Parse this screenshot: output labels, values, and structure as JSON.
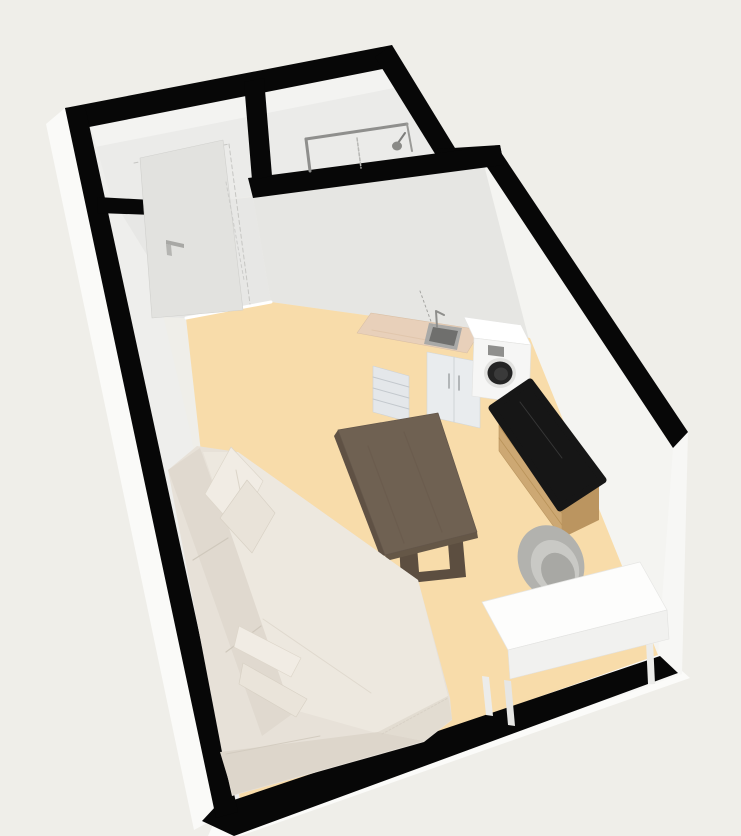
{
  "view": {
    "type": "3d-floorplan-render",
    "width": 741,
    "height": 836,
    "background": "#efeee9"
  },
  "palette": {
    "wall_top": "#070707",
    "wall_outer_face": "#fafaf8",
    "wall_inner_face": "#f3f3f1",
    "hall_floor": "#e7e7e5",
    "living_floor": "#f8dcaa",
    "sofa_cream": "#e7e1d8",
    "table_wood": "#6f6152",
    "sideboard_wood": "#cda873",
    "sideboard_marble": "#161616",
    "kitchen_counter": "#e8d0ba",
    "appliance_white": "#f6f6f5",
    "chair_gray": "#b2b2ae",
    "desk_white": "#fdfdfc"
  },
  "rooms": [
    {
      "name": "entry-hall",
      "floor_color": "#e7e7e5"
    },
    {
      "name": "bathroom",
      "floor_color": "#ebebe9"
    },
    {
      "name": "living-room-kitchen",
      "floor_color": "#f8dcaa"
    }
  ],
  "furniture": [
    {
      "name": "entry-door",
      "color": "#e2e2df"
    },
    {
      "name": "shower",
      "color": "#8f8f8d"
    },
    {
      "name": "kitchen-counter-sink",
      "color": "#e8d0ba"
    },
    {
      "name": "washing-machine",
      "color": "#f6f6f5"
    },
    {
      "name": "sideboard",
      "color": "#cda873"
    },
    {
      "name": "chair",
      "color": "#b2b2ae"
    },
    {
      "name": "desk",
      "color": "#fdfdfc"
    },
    {
      "name": "dining-table",
      "color": "#6f6152"
    },
    {
      "name": "sectional-sofa",
      "color": "#e7e1d8"
    }
  ],
  "shapes": [
    {
      "name": "background",
      "kind": "polygon",
      "points": "0,0 741,0 741,836 0,836",
      "fill": "#efeee9",
      "interactable": false
    },
    {
      "name": "wall-outer-face-left",
      "kind": "polygon",
      "points": "65,108 218,817 194,830 46,124",
      "fill": "#fafaf8",
      "interactable": false
    },
    {
      "name": "wall-outer-face-bottom",
      "kind": "polygon",
      "points": "216,818 672,662 690,678 240,836 208,836",
      "fill": "#fbfbf9",
      "interactable": false
    },
    {
      "name": "wall-outer-face-right",
      "kind": "polygon",
      "points": "688,432 682,674 610,700 600,600 650,470",
      "fill": "#f7f7f5",
      "interactable": false
    },
    {
      "name": "hall-bathroom-interior",
      "kind": "polygon",
      "points": "74,130 398,66 440,158 503,148 253,196 153,212 97,210",
      "fill": "#ebebe9",
      "interactable": false
    },
    {
      "name": "wall-face-top-inner",
      "kind": "polygon",
      "points": "74,130 398,66 404,86 80,150",
      "fill": "#f3f3f1",
      "interactable": false
    },
    {
      "name": "hall-corridor-floor",
      "kind": "polygon",
      "points": "118,212 253,197 271,302 186,318 136,316",
      "fill": "#e7e7e5",
      "interactable": false
    },
    {
      "name": "wall-face-partition",
      "kind": "polygon",
      "points": "253,197 504,164 530,338 271,302",
      "fill": "#e6e6e3",
      "interactable": false
    },
    {
      "name": "wall-face-right-inner",
      "kind": "polygon",
      "points": "483,161 673,448 658,656 528,336",
      "fill": "#f4f4f1",
      "interactable": false
    },
    {
      "name": "wall-face-left-inner",
      "kind": "polygon",
      "points": "85,106 238,812 254,786 190,430 150,260 110,195",
      "fill": "#eeeeec",
      "interactable": false
    },
    {
      "name": "wall-face-bottom-inner",
      "kind": "polygon",
      "points": "218,808 658,654 662,660 222,814",
      "fill": "#fafaf8",
      "interactable": false
    },
    {
      "name": "floor-living-room",
      "kind": "polygon",
      "points": "186,318 271,302 530,338 658,655 240,802",
      "fill": "#f8dcaa",
      "interactable": false
    },
    {
      "name": "floor-threshold-line",
      "kind": "line",
      "points": "186,318 271,302",
      "stroke": "#ffffff",
      "sw": 3,
      "interactable": false
    },
    {
      "name": "wall-top-northwest",
      "kind": "polygon",
      "points": "65,108 392,45 398,66 74,130",
      "fill": "#070707",
      "interactable": false
    },
    {
      "name": "wall-top-bathroom-right",
      "kind": "polygon",
      "points": "392,45 455,148 437,157 375,57",
      "fill": "#070707",
      "interactable": false
    },
    {
      "name": "wall-top-jog",
      "kind": "polygon",
      "points": "437,149 500,145 504,165 441,160",
      "fill": "#070707",
      "interactable": false
    },
    {
      "name": "wall-top-right",
      "kind": "polygon",
      "points": "496,145 688,432 673,448 483,161",
      "fill": "#070707",
      "interactable": false
    },
    {
      "name": "wall-top-bottom",
      "kind": "polygon",
      "points": "216,806 660,656 678,673 234,836 202,821",
      "fill": "#070707",
      "interactable": false
    },
    {
      "name": "wall-top-left",
      "kind": "polygon",
      "points": "65,108 85,106 238,812 216,818",
      "fill": "#070707",
      "interactable": false
    },
    {
      "name": "wall-top-partition-stub",
      "kind": "polygon",
      "points": "97,197 152,200 153,215 98,213",
      "fill": "#070707",
      "interactable": false
    },
    {
      "name": "wall-top-partition-main",
      "kind": "polygon",
      "points": "248,178 500,145 504,165 253,198",
      "fill": "#070707",
      "interactable": false
    },
    {
      "name": "wall-top-hall-bath-divider",
      "kind": "polygon",
      "points": "244,82 264,78 272,176 252,180",
      "fill": "#070707",
      "interactable": false
    },
    {
      "name": "door-casing-dash-top",
      "kind": "line",
      "points": "134,163 229,144",
      "stroke": "#c6c6c3",
      "sw": 1,
      "dash": "4,3",
      "interactable": false
    },
    {
      "name": "door-casing-dash-right",
      "kind": "line",
      "points": "229,144 250,304",
      "stroke": "#c6c6c3",
      "sw": 1,
      "dash": "4,3",
      "interactable": false
    },
    {
      "name": "entry-door-leaf",
      "kind": "polygon",
      "points": "140,158 223,140 243,310 152,318",
      "fill": "#e2e2df",
      "stroke": "#d0d0cd",
      "sw": 0.6,
      "interactable": true
    },
    {
      "name": "door-handle-icon",
      "kind": "polygon",
      "points": "166,240 184,244 184,248 166,244",
      "fill": "#a8a8a5",
      "interactable": true
    },
    {
      "name": "door-handle-stem",
      "kind": "polygon",
      "points": "166,244 171,245 172,256 167,255",
      "fill": "#b5b5b2",
      "interactable": false
    },
    {
      "name": "corridor-guide-dash",
      "kind": "line",
      "points": "226,182 244,280",
      "stroke": "#cccccA",
      "sw": 1,
      "dash": "3,3",
      "interactable": false
    },
    {
      "name": "shower-frame-top-bar",
      "kind": "line",
      "points": "306,139 407,124",
      "stroke": "#8f8f8d",
      "sw": 3,
      "interactable": true
    },
    {
      "name": "shower-frame-left-bar",
      "kind": "line",
      "points": "306,139 310,171",
      "stroke": "#8f8f8d",
      "sw": 3,
      "interactable": false
    },
    {
      "name": "shower-frame-right-bar",
      "kind": "line",
      "points": "407,124 412,151",
      "stroke": "#9a9a97",
      "sw": 2,
      "interactable": false
    },
    {
      "name": "shower-glass-dash",
      "kind": "line",
      "points": "357,138 361,168",
      "stroke": "#b8b8b5",
      "sw": 1.5,
      "dash": "3,2",
      "interactable": false
    },
    {
      "name": "shower-head-arm",
      "kind": "line",
      "points": "405,133 398,143",
      "stroke": "#7e7e7c",
      "sw": 2,
      "interactable": false
    },
    {
      "name": "shower-head-icon",
      "kind": "ellipse",
      "cx": 397,
      "cy": 146,
      "rx": 5,
      "ry": 4.5,
      "fill": "#8a8a87",
      "interactable": true
    },
    {
      "name": "kitchen-drawer-unit",
      "kind": "polygon",
      "points": "373,366 409,376 409,422 373,412",
      "fill": "#e4e7ea",
      "stroke": "#cdd2d7",
      "sw": 0.6,
      "interactable": true
    },
    {
      "name": "kitchen-drawer-line-1",
      "kind": "line",
      "points": "373,377 409,387",
      "stroke": "#c3c8cd",
      "sw": 1,
      "interactable": false
    },
    {
      "name": "kitchen-drawer-line-2",
      "kind": "line",
      "points": "373,388 409,398",
      "stroke": "#c3c8cd",
      "sw": 1,
      "interactable": false
    },
    {
      "name": "kitchen-drawer-line-3",
      "kind": "line",
      "points": "373,399 409,409",
      "stroke": "#c3c8cd",
      "sw": 1,
      "interactable": false
    },
    {
      "name": "kitchen-sink-cabinet",
      "kind": "polygon",
      "points": "427,352 480,362 480,428 427,416",
      "fill": "#e9ecee",
      "stroke": "#d2d7da",
      "sw": 0.6,
      "interactable": true
    },
    {
      "name": "cabinet-door-split-line",
      "kind": "line",
      "points": "454,357 454,422",
      "stroke": "#cfd4d7",
      "sw": 1,
      "interactable": false
    },
    {
      "name": "cabinet-handle-left",
      "kind": "line",
      "points": "449,374 449,388",
      "stroke": "#9fa3a6",
      "sw": 1.5,
      "interactable": false
    },
    {
      "name": "cabinet-handle-right",
      "kind": "line",
      "points": "459,376 459,390",
      "stroke": "#9fa3a6",
      "sw": 1.5,
      "interactable": false
    },
    {
      "name": "kitchen-countertop",
      "kind": "polygon",
      "points": "357,333 371,313 481,330 467,353",
      "fill": "#e8d0ba",
      "stroke": "#d9bfa5",
      "sw": 0.6,
      "interactable": true
    },
    {
      "name": "countertop-streak",
      "kind": "line",
      "points": "372,330 432,341",
      "stroke": "#dfc3a9",
      "sw": 1,
      "opacity": 0.8,
      "interactable": false
    },
    {
      "name": "kitchen-sink-rim",
      "kind": "polygon",
      "points": "429,323 462,328 457,350 424,344",
      "fill": "#a9a9a7",
      "interactable": true
    },
    {
      "name": "kitchen-sink-basin",
      "kind": "polygon",
      "points": "433,327 458,331 454,346 429,341",
      "fill": "#6f6f6d",
      "interactable": false
    },
    {
      "name": "kitchen-faucet-icon",
      "kind": "path",
      "d": "M437,327 L436,311 L444,315",
      "fill": "none",
      "stroke": "#8e8e8b",
      "sw": 2,
      "interactable": false
    },
    {
      "name": "plumbing-guide-dash",
      "kind": "line",
      "points": "420,291 433,327",
      "stroke": "#a5a5a2",
      "sw": 1,
      "dash": "2,3",
      "interactable": false
    },
    {
      "name": "washing-machine-top",
      "kind": "polygon",
      "points": "464,317 521,325 531,345 474,338",
      "fill": "#ffffff",
      "stroke": "#e5e5e3",
      "sw": 0.6,
      "interactable": true
    },
    {
      "name": "washing-machine-front",
      "kind": "polygon",
      "points": "474,338 531,345 529,404 472,396",
      "fill": "#f6f6f5",
      "stroke": "#e2e2e0",
      "sw": 0.6,
      "interactable": true
    },
    {
      "name": "washer-control-panel",
      "kind": "polygon",
      "points": "488,345 504,347 504,357 488,355",
      "fill": "#8f8f8d",
      "interactable": false
    },
    {
      "name": "washer-door-ring",
      "kind": "ellipse",
      "cx": 500,
      "cy": 373,
      "rx": 16,
      "ry": 15,
      "fill": "#e2e2e0",
      "interactable": false
    },
    {
      "name": "washer-door",
      "kind": "ellipse",
      "cx": 500,
      "cy": 373,
      "rx": 12.5,
      "ry": 11.5,
      "fill": "#242424",
      "interactable": true
    },
    {
      "name": "washer-door-glass",
      "kind": "ellipse",
      "cx": 501,
      "cy": 374,
      "rx": 7,
      "ry": 6.5,
      "fill": "#3a3a3a",
      "interactable": false
    },
    {
      "name": "sideboard-front-face",
      "kind": "polygon",
      "points": "499,413 562,500 562,538 499,451",
      "fill": "#cda873",
      "stroke": "#b9955f",
      "sw": 0.6,
      "interactable": true
    },
    {
      "name": "sideboard-end-face",
      "kind": "polygon",
      "points": "562,500 599,486 599,520 562,538",
      "fill": "#bb9560",
      "interactable": false
    },
    {
      "name": "sideboard-drawer-line-1",
      "kind": "line",
      "points": "499,426 562,513",
      "stroke": "#b08a4e",
      "sw": 0.8,
      "opacity": 0.7,
      "interactable": false
    },
    {
      "name": "sideboard-drawer-line-2",
      "kind": "line",
      "points": "499,438 562,525",
      "stroke": "#b08a4e",
      "sw": 0.8,
      "opacity": 0.7,
      "interactable": false
    },
    {
      "name": "sideboard-marble-top",
      "kind": "polygon",
      "points": "530,382 603,480 560,508 492,408",
      "fill": "#161616",
      "stroke": "#161616",
      "sw": 7,
      "join": "round",
      "interactable": true
    },
    {
      "name": "marble-vein-line",
      "kind": "line",
      "points": "520,402 562,458",
      "stroke": "#3a3a3a",
      "sw": 1,
      "opacity": 0.9,
      "interactable": false
    },
    {
      "name": "chair-back",
      "kind": "ellipse",
      "cx": 551,
      "cy": 562,
      "rx": 32,
      "ry": 38,
      "fill": "#b2b2ae",
      "transform": "rotate(-28 551 562)",
      "interactable": true
    },
    {
      "name": "chair-back-inner",
      "kind": "ellipse",
      "cx": 555,
      "cy": 567,
      "rx": 23,
      "ry": 28,
      "fill": "#c9c9c5",
      "transform": "rotate(-28 555 567)",
      "interactable": false
    },
    {
      "name": "chair-seat",
      "kind": "ellipse",
      "cx": 558,
      "cy": 572,
      "rx": 16,
      "ry": 20,
      "fill": "#a8a8a4",
      "transform": "rotate(-28 558 572)",
      "interactable": false
    },
    {
      "name": "desk-leg-back",
      "kind": "polygon",
      "points": "482,676 489,677 493,716 486,715",
      "fill": "#ececea",
      "interactable": false
    },
    {
      "name": "desk-leg-front",
      "kind": "polygon",
      "points": "504,680 511,681 515,726 508,725",
      "fill": "#e6e6e4",
      "interactable": false
    },
    {
      "name": "desk-leg-right",
      "kind": "polygon",
      "points": "645,620 652,620 655,684 648,684",
      "fill": "#ececea",
      "interactable": false
    },
    {
      "name": "desk-top",
      "kind": "polygon",
      "points": "482,602 640,562 667,610 508,650",
      "fill": "#fdfdfc",
      "stroke": "#e6e6e4",
      "sw": 0.7,
      "interactable": true
    },
    {
      "name": "desk-front-face",
      "kind": "polygon",
      "points": "508,650 667,610 669,639 510,679",
      "fill": "#f1f1ef",
      "stroke": "#e2e2e0",
      "sw": 0.6,
      "interactable": false
    },
    {
      "name": "table-leg-frame",
      "kind": "polygon",
      "points": "399,538 462,531 466,577 401,584",
      "fill": "#5c4e40",
      "interactable": false
    },
    {
      "name": "table-leg-cutout",
      "kind": "polygon",
      "points": "417,546 448,543 450,569 419,572",
      "fill": "#f8dcaa",
      "interactable": false
    },
    {
      "name": "table-edge-left",
      "kind": "polygon",
      "points": "338,430 385,555 382,561 334,436",
      "fill": "#5f5144",
      "interactable": false
    },
    {
      "name": "table-edge-bottom",
      "kind": "polygon",
      "points": "385,555 477,532 478,538 386,561",
      "fill": "#655747",
      "interactable": false
    },
    {
      "name": "dining-table-top",
      "kind": "polygon",
      "points": "438,413 477,532 385,555 338,430",
      "fill": "#6f6152",
      "stroke": "#63564a",
      "sw": 0.7,
      "interactable": true
    },
    {
      "name": "table-grain-line-1",
      "kind": "line",
      "points": "368,446 404,543",
      "stroke": "#685a4b",
      "sw": 1.2,
      "opacity": 0.55,
      "interactable": false
    },
    {
      "name": "table-grain-line-2",
      "kind": "line",
      "points": "404,432 442,532",
      "stroke": "#685a4b",
      "sw": 1.2,
      "opacity": 0.55,
      "interactable": false
    },
    {
      "name": "sofa-base",
      "kind": "polygon",
      "points": "168,470 197,446 238,452 418,580 450,698 452,720 424,742 232,796 222,752",
      "fill": "#e7e1d8",
      "interactable": true
    },
    {
      "name": "sofa-back-band",
      "kind": "polygon",
      "points": "168,470 200,448 295,712 262,736",
      "fill": "#e0d9cf",
      "interactable": false
    },
    {
      "name": "sofa-back-seam-1",
      "kind": "line",
      "points": "193,560 228,538",
      "stroke": "#cfc8bc",
      "sw": 1.2,
      "interactable": false
    },
    {
      "name": "sofa-back-seam-2",
      "kind": "line",
      "points": "226,652 261,626",
      "stroke": "#cfc8bc",
      "sw": 1.2,
      "interactable": false
    },
    {
      "name": "sofa-seat-top",
      "kind": "polygon",
      "points": "203,452 238,452 418,580 448,696 376,733 291,709",
      "fill": "#ede8df",
      "interactable": false
    },
    {
      "name": "sofa-seat-edge-line",
      "kind": "line",
      "points": "263,619 371,693",
      "stroke": "#ded7cc",
      "sw": 1,
      "opacity": 0.9,
      "interactable": false
    },
    {
      "name": "sofa-front-face-long",
      "kind": "polygon",
      "points": "378,732 424,741 233,795 220,752",
      "fill": "#ddd6cb",
      "interactable": false
    },
    {
      "name": "sofa-front-face-right",
      "kind": "polygon",
      "points": "448,696 452,719 424,741 378,732",
      "fill": "#e2dcd1",
      "interactable": false
    },
    {
      "name": "sofa-armrest-crease",
      "kind": "line",
      "points": "226,754 320,736",
      "stroke": "#d3ccc0",
      "sw": 1,
      "interactable": false
    },
    {
      "name": "sofa-chaise-stitch",
      "kind": "line",
      "points": "382,734 448,698",
      "stroke": "#d8d1c6",
      "sw": 1,
      "dash": "2,2",
      "interactable": false
    },
    {
      "name": "throw-pillow-1",
      "kind": "polygon",
      "points": "231,447 263,481 238,531 205,494",
      "fill": "#f1ece4",
      "stroke": "#ddd6ca",
      "sw": 0.7,
      "interactable": true
    },
    {
      "name": "pillow-1-fold-line",
      "kind": "line",
      "points": "236,470 244,510",
      "stroke": "#dcd5c9",
      "sw": 1,
      "interactable": false
    },
    {
      "name": "throw-pillow-2",
      "kind": "polygon",
      "points": "247,480 275,513 252,553 220,518",
      "fill": "#e9e3d9",
      "stroke": "#d8d1c5",
      "sw": 0.7,
      "interactable": true
    },
    {
      "name": "throw-pillow-3",
      "kind": "polygon",
      "points": "239,626 301,658 291,677 234,647",
      "fill": "#f1ece4",
      "stroke": "#ddd6ca",
      "sw": 0.7,
      "interactable": true
    },
    {
      "name": "throw-pillow-4",
      "kind": "polygon",
      "points": "243,663 307,699 296,717 239,684",
      "fill": "#eae4da",
      "stroke": "#d8d1c5",
      "sw": 0.7,
      "interactable": true
    }
  ]
}
